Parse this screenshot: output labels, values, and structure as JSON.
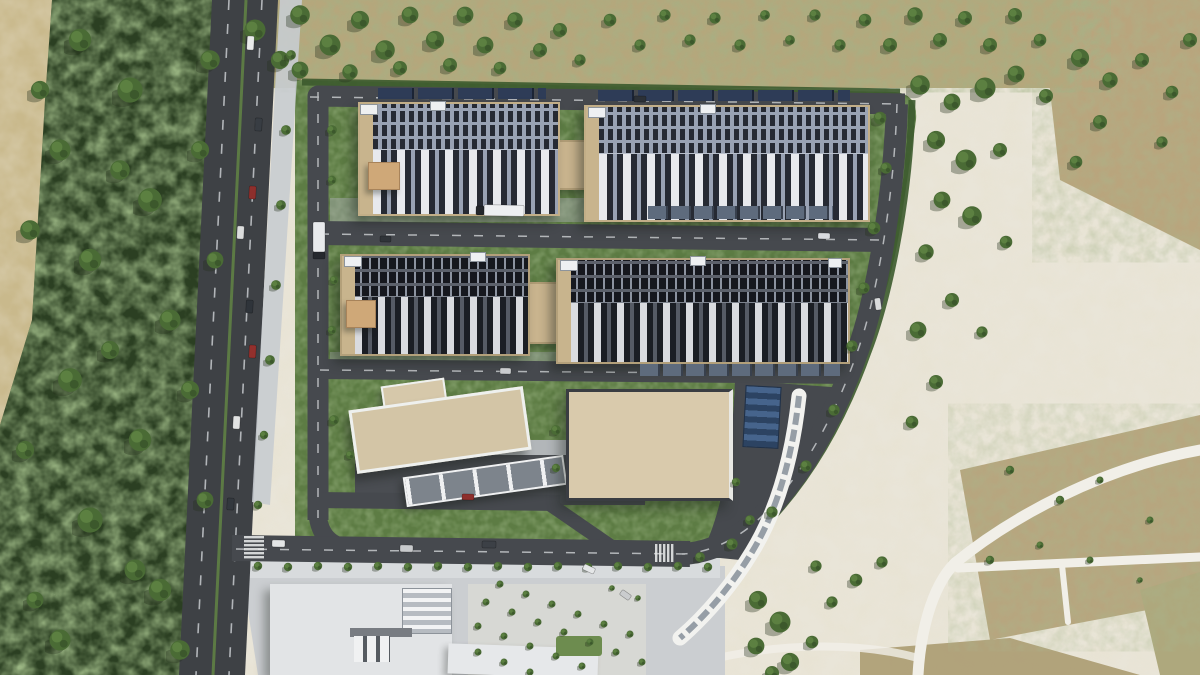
{
  "meta": {
    "title": "Aerial rendering of a data center campus",
    "type": "architectural-aerial-render",
    "visible_text": "none"
  },
  "palette": {
    "forest_base": "#2b3f22",
    "forest_canopy": "#4f7337",
    "lawn": "#5d7c44",
    "sand": "#e9e5d8",
    "scrub": "#b3a478",
    "dry_brown": "#b49f74",
    "asphalt_public": "#3e4145",
    "asphalt_campus": "#46494e",
    "hall_roof_light": "#99a2b3",
    "hall_roof_dark": "#5c616b",
    "ahu_white": "#e7e9ed",
    "louver_dark": "#262a33",
    "tan_trim": "#c8b48d",
    "solar_blue": "#2e3c57",
    "substation_roof": "#d9caac",
    "canopy_white": "#f2f2ef"
  },
  "scene": {
    "regions": [
      "forest-west",
      "public-road-west",
      "gravel-path",
      "scrubland-north",
      "data-center-campus",
      "sandy-terrain-east",
      "dry-brown-patches",
      "south-logistics-complex",
      "tree-plaza-south",
      "footpaths-southeast"
    ],
    "buildings": {
      "data_halls_light": 2,
      "data_halls_dark": 2,
      "admin_building": 1,
      "gatehouse_canopy": 1,
      "substation_tan_roof": 1,
      "curved_canopy_walkway": 1,
      "logistics_buildings_south": 2
    },
    "trees": [
      [
        80,
        40,
        16
      ],
      [
        130,
        90,
        18
      ],
      [
        60,
        150,
        15
      ],
      [
        150,
        200,
        17
      ],
      [
        90,
        260,
        16
      ],
      [
        170,
        320,
        15
      ],
      [
        70,
        380,
        17
      ],
      [
        140,
        440,
        16
      ],
      [
        90,
        520,
        18
      ],
      [
        160,
        590,
        16
      ],
      [
        60,
        640,
        15
      ],
      [
        210,
        60,
        14
      ],
      [
        200,
        150,
        13
      ],
      [
        215,
        260,
        12
      ],
      [
        190,
        390,
        13
      ],
      [
        205,
        500,
        12
      ],
      [
        180,
        650,
        14
      ],
      [
        120,
        170,
        14
      ],
      [
        110,
        350,
        13
      ],
      [
        135,
        570,
        15
      ],
      [
        40,
        90,
        13
      ],
      [
        30,
        230,
        14
      ],
      [
        25,
        450,
        13
      ],
      [
        35,
        600,
        12
      ],
      [
        255,
        30,
        15
      ],
      [
        280,
        60,
        13
      ],
      [
        300,
        15,
        14
      ],
      [
        330,
        45,
        15
      ],
      [
        360,
        20,
        13
      ],
      [
        385,
        50,
        14
      ],
      [
        410,
        15,
        12
      ],
      [
        435,
        40,
        13
      ],
      [
        465,
        15,
        12
      ],
      [
        485,
        45,
        12
      ],
      [
        515,
        20,
        11
      ],
      [
        540,
        50,
        10
      ],
      [
        300,
        70,
        12
      ],
      [
        350,
        72,
        11
      ],
      [
        400,
        68,
        10
      ],
      [
        450,
        65,
        10
      ],
      [
        500,
        68,
        9
      ],
      [
        560,
        30,
        10
      ],
      [
        580,
        60,
        8
      ],
      [
        610,
        20,
        9
      ],
      [
        640,
        45,
        8
      ],
      [
        665,
        15,
        8
      ],
      [
        690,
        40,
        8
      ],
      [
        715,
        18,
        8
      ],
      [
        740,
        45,
        8
      ],
      [
        765,
        15,
        7
      ],
      [
        790,
        40,
        7
      ],
      [
        815,
        15,
        8
      ],
      [
        840,
        45,
        8
      ],
      [
        865,
        20,
        9
      ],
      [
        890,
        45,
        10
      ],
      [
        915,
        15,
        11
      ],
      [
        940,
        40,
        10
      ],
      [
        965,
        18,
        10
      ],
      [
        990,
        45,
        10
      ],
      [
        1015,
        15,
        10
      ],
      [
        1040,
        40,
        9
      ],
      [
        920,
        85,
        14
      ],
      [
        952,
        102,
        12
      ],
      [
        985,
        88,
        15
      ],
      [
        1016,
        74,
        12
      ],
      [
        1046,
        96,
        10
      ],
      [
        936,
        140,
        13
      ],
      [
        966,
        160,
        15
      ],
      [
        1000,
        150,
        10
      ],
      [
        942,
        200,
        12
      ],
      [
        972,
        216,
        14
      ],
      [
        926,
        252,
        11
      ],
      [
        1006,
        242,
        9
      ],
      [
        952,
        300,
        10
      ],
      [
        918,
        330,
        12
      ],
      [
        982,
        332,
        8
      ],
      [
        936,
        382,
        10
      ],
      [
        912,
        422,
        9
      ],
      [
        1080,
        58,
        13
      ],
      [
        1110,
        80,
        11
      ],
      [
        1142,
        60,
        10
      ],
      [
        1172,
        92,
        9
      ],
      [
        1100,
        122,
        10
      ],
      [
        1162,
        142,
        8
      ],
      [
        1076,
        162,
        9
      ],
      [
        1190,
        40,
        10
      ],
      [
        1010,
        470,
        6
      ],
      [
        1060,
        500,
        6
      ],
      [
        1100,
        480,
        5
      ],
      [
        1150,
        520,
        5
      ],
      [
        1040,
        545,
        5
      ],
      [
        990,
        560,
        6
      ],
      [
        1090,
        560,
        5
      ],
      [
        1140,
        580,
        4
      ],
      [
        758,
        600,
        13
      ],
      [
        780,
        622,
        15
      ],
      [
        756,
        646,
        12
      ],
      [
        790,
        662,
        13
      ],
      [
        772,
        673,
        10
      ],
      [
        812,
        642,
        9
      ],
      [
        832,
        602,
        8
      ],
      [
        856,
        580,
        9
      ],
      [
        882,
        562,
        8
      ],
      [
        816,
        566,
        8
      ],
      [
        880,
        118,
        9
      ],
      [
        886,
        168,
        8
      ],
      [
        874,
        228,
        9
      ],
      [
        864,
        288,
        8
      ],
      [
        852,
        346,
        8
      ],
      [
        834,
        410,
        8
      ],
      [
        806,
        466,
        8
      ],
      [
        772,
        512,
        8
      ],
      [
        732,
        544,
        8
      ],
      [
        700,
        557,
        7
      ],
      [
        291,
        55,
        7
      ],
      [
        286,
        130,
        7
      ],
      [
        281,
        205,
        7
      ],
      [
        276,
        285,
        7
      ],
      [
        270,
        360,
        7
      ],
      [
        264,
        435,
        6
      ],
      [
        258,
        505,
        6
      ],
      [
        258,
        566,
        6
      ],
      [
        288,
        567,
        6
      ],
      [
        318,
        566,
        6
      ],
      [
        348,
        567,
        6
      ],
      [
        378,
        566,
        6
      ],
      [
        408,
        567,
        6
      ],
      [
        438,
        566,
        6
      ],
      [
        468,
        567,
        6
      ],
      [
        498,
        566,
        6
      ],
      [
        528,
        567,
        6
      ],
      [
        558,
        566,
        6
      ],
      [
        588,
        567,
        6
      ],
      [
        618,
        566,
        6
      ],
      [
        648,
        567,
        6
      ],
      [
        678,
        566,
        6
      ],
      [
        708,
        567,
        6
      ],
      [
        500,
        584,
        5
      ],
      [
        526,
        594,
        5
      ],
      [
        552,
        604,
        5
      ],
      [
        578,
        614,
        5
      ],
      [
        604,
        624,
        5
      ],
      [
        630,
        634,
        5
      ],
      [
        486,
        602,
        5
      ],
      [
        512,
        612,
        5
      ],
      [
        538,
        622,
        5
      ],
      [
        564,
        632,
        5
      ],
      [
        590,
        642,
        5
      ],
      [
        616,
        652,
        5
      ],
      [
        642,
        662,
        5
      ],
      [
        478,
        626,
        5
      ],
      [
        504,
        636,
        5
      ],
      [
        530,
        646,
        5
      ],
      [
        556,
        656,
        5
      ],
      [
        582,
        666,
        5
      ],
      [
        478,
        652,
        5
      ],
      [
        504,
        662,
        5
      ],
      [
        530,
        672,
        5
      ],
      [
        612,
        588,
        4
      ],
      [
        638,
        598,
        4
      ],
      [
        332,
        130,
        7
      ],
      [
        332,
        180,
        6
      ],
      [
        334,
        280,
        6
      ],
      [
        332,
        330,
        6
      ],
      [
        334,
        420,
        7
      ],
      [
        350,
        455,
        6
      ],
      [
        556,
        430,
        7
      ],
      [
        556,
        468,
        6
      ],
      [
        750,
        520,
        7
      ],
      [
        736,
        482,
        6
      ]
    ],
    "vehicles": [
      [
        247,
        36,
        7,
        14,
        "#e9eaea",
        3
      ],
      [
        255,
        118,
        7,
        13,
        "#383d43",
        3
      ],
      [
        249,
        186,
        7,
        13,
        "#8e2f2c",
        3
      ],
      [
        237,
        226,
        7,
        13,
        "#dcdddd",
        3
      ],
      [
        246,
        300,
        7,
        13,
        "#2f343a",
        3
      ],
      [
        249,
        345,
        7,
        13,
        "#93302d",
        3
      ],
      [
        233,
        416,
        7,
        13,
        "#e2e3e3",
        3
      ],
      [
        227,
        498,
        7,
        12,
        "#33383e",
        3
      ],
      [
        484,
        205,
        40,
        11,
        "#edeff1",
        1
      ],
      [
        476,
        206,
        8,
        9,
        "#23262b",
        1
      ],
      [
        313,
        222,
        12,
        30,
        "#e8eaec",
        0
      ],
      [
        313,
        252,
        12,
        7,
        "#26292e",
        0
      ],
      [
        634,
        96,
        12,
        6,
        "#2c3137",
        1
      ],
      [
        818,
        233,
        12,
        6,
        "#d8dade",
        1
      ],
      [
        380,
        236,
        11,
        6,
        "#303439",
        1
      ],
      [
        500,
        368,
        11,
        6,
        "#caccce",
        1
      ],
      [
        272,
        540,
        13,
        7,
        "#e3e5e6",
        1
      ],
      [
        400,
        545,
        13,
        7,
        "#c8cacc",
        1
      ],
      [
        482,
        541,
        14,
        7,
        "#3c4046",
        1
      ],
      [
        583,
        566,
        12,
        6,
        "#e5e7e8",
        25
      ],
      [
        620,
        592,
        11,
        6,
        "#caccce",
        35
      ],
      [
        875,
        298,
        6,
        12,
        "#d9dbdc",
        -8
      ],
      [
        462,
        494,
        12,
        6,
        "#8e2f2c",
        1
      ]
    ]
  }
}
